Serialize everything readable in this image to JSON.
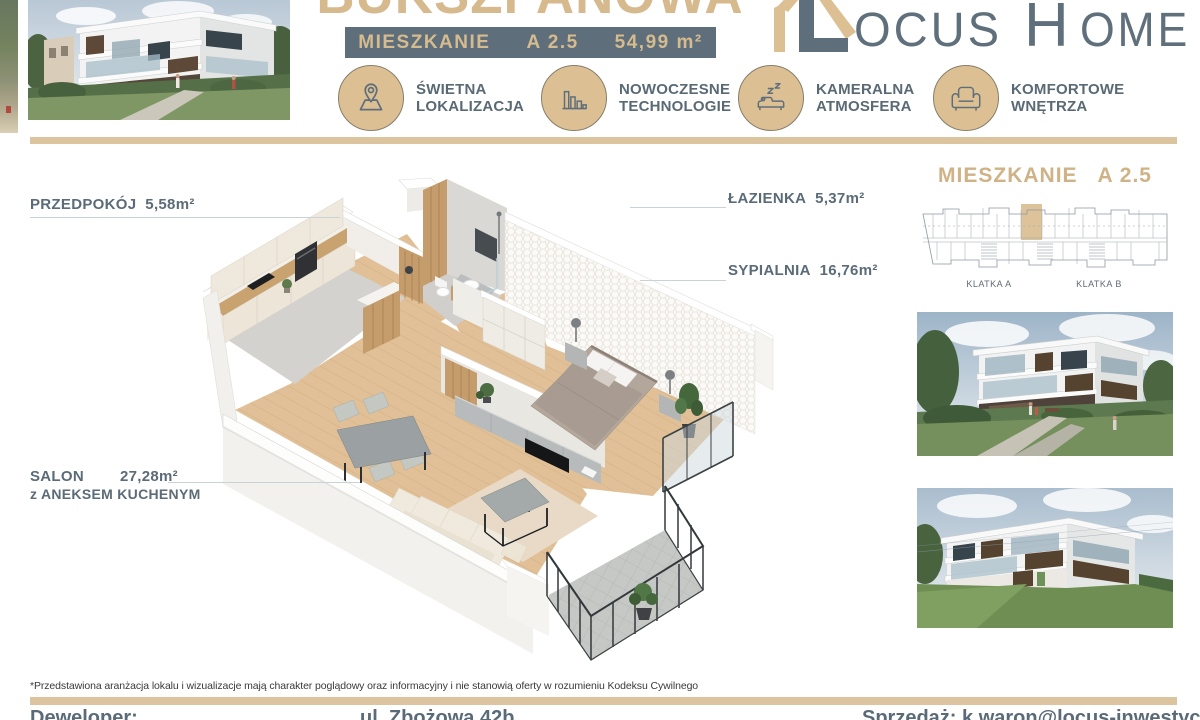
{
  "header": {
    "title": "BUKSZPANOWA",
    "badge": {
      "label": "MIESZKANIE",
      "unit": "A 2.5",
      "area": "54,99 m²"
    },
    "logo": {
      "l": "L",
      "ocus": "OCUS",
      "h": "H",
      "ome": "OME"
    },
    "features": [
      {
        "icon": "map-pin-icon",
        "line1": "ŚWIETNA",
        "line2": "LOKALIZACJA"
      },
      {
        "icon": "bar-chart-icon",
        "line1": "NOWOCZESNE",
        "line2": "TECHNOLOGIE"
      },
      {
        "icon": "sleeping-sofa-icon",
        "line1": "KAMERALNA",
        "line2": "ATMOSFERA"
      },
      {
        "icon": "armchair-icon",
        "line1": "KOMFORTOWE",
        "line2": "WNĘTRZA"
      }
    ]
  },
  "plan": {
    "rooms": [
      {
        "name": "PRZEDPOKÓJ",
        "area": "5,58m²"
      },
      {
        "name": "ŁAZIENKA",
        "area": "5,37m²"
      },
      {
        "name": "SYPIALNIA",
        "area": "16,76m²"
      },
      {
        "name": "SALON",
        "area": "27,28m²",
        "suffix": "z ANEKSEM KUCHENYM"
      }
    ]
  },
  "sidebar": {
    "heading_label": "MIESZKANIE",
    "heading_unit": "A 2.5",
    "stairwell_a": "KLATKA A",
    "stairwell_b": "KLATKA B"
  },
  "footer": {
    "disclaimer": "*Przedstawiona aranżacja lokalu i wizualizacje mają charakter poglądowy oraz informacyjny i nie stanowią oferty w rozumieniu Kodeksu Cywilnego",
    "developer_label": "Deweloper:",
    "address": "ul. Zbożowa 42b",
    "sales": "Sprzedaż: k.waron@locus-inwestycje.pl"
  },
  "colors": {
    "gold": "#d6ba8e",
    "slate": "#5e6e7b",
    "tan_bar": "#dcc49e"
  }
}
